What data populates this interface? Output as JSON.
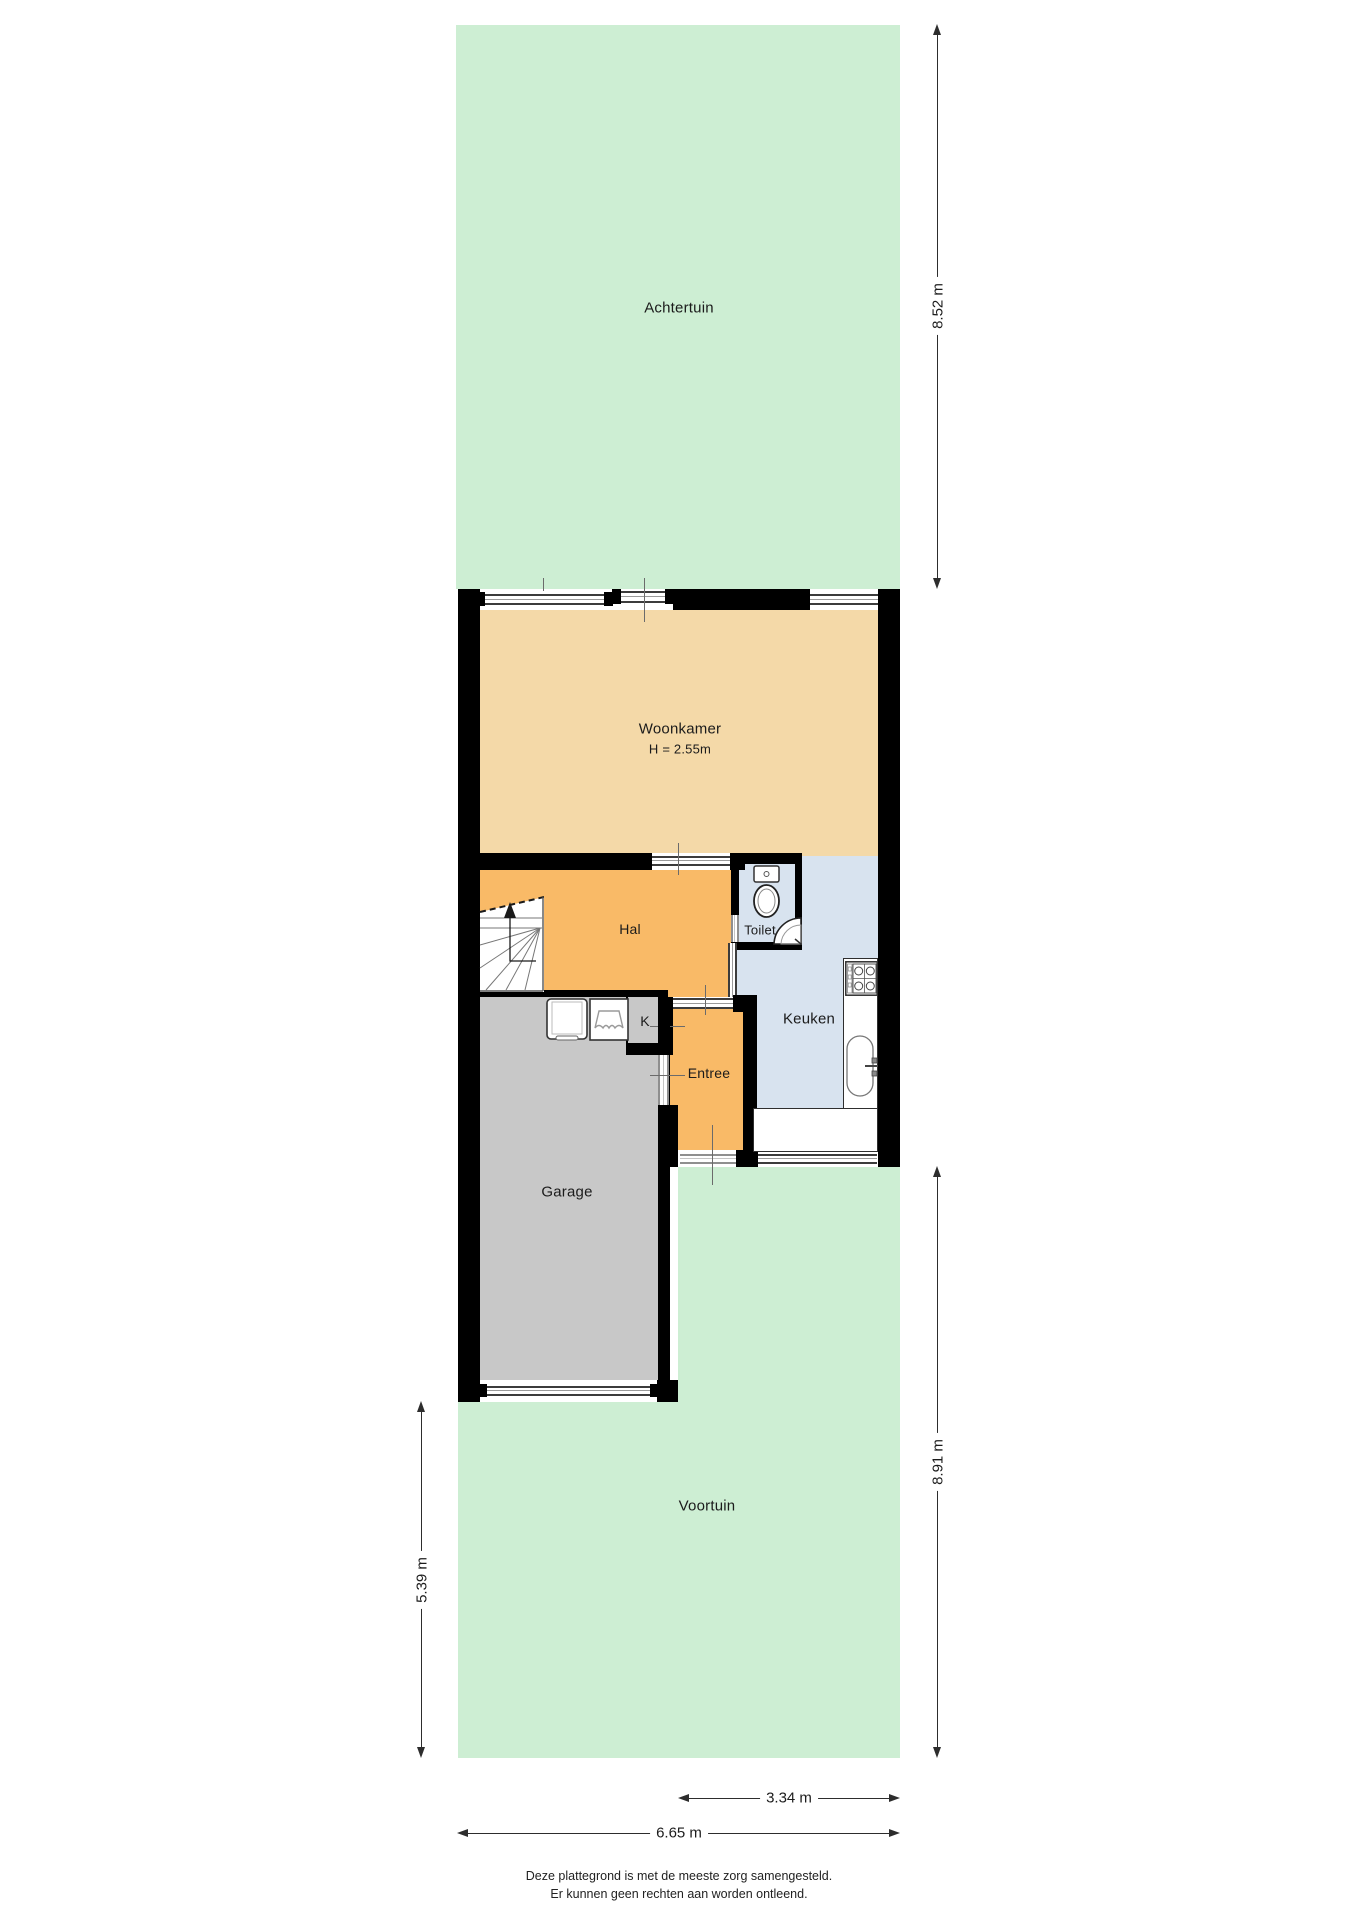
{
  "rooms": {
    "achtertuin": "Achtertuin",
    "woonkamer": "Woonkamer",
    "woonkamer_height": "H = 2.55m",
    "hal": "Hal",
    "toilet": "Toilet",
    "keuken": "Keuken",
    "kast": "K",
    "entree": "Entree",
    "garage": "Garage",
    "voortuin": "Voortuin"
  },
  "dimensions": {
    "achtertuin_depth": "8.52 m",
    "voortuin_depth_right": "8.91 m",
    "voortuin_depth_left": "5.39 m",
    "front_width_partial": "3.34 m",
    "front_width_total": "6.65 m"
  },
  "footer": {
    "line1": "Deze plattegrond is met de meeste zorg samengesteld.",
    "line2": "Er kunnen geen rechten aan worden ontleend."
  },
  "colors": {
    "garden": "#cdeed3",
    "living_room": "#f4d9a8",
    "hall": "#f9ba67",
    "closet": "#dab076",
    "kitchen": "#d8e3ef",
    "garage": "#c8c8c8",
    "wall": "#000000",
    "dimension": "#2d2d2d"
  },
  "icons": {
    "stairs": "stairs-icon",
    "cistern": "cistern-icon",
    "toilet_bowl": "toilet-bowl-icon",
    "corner_basin": "corner-basin-icon",
    "stove": "stove-icon",
    "sink": "sink-icon",
    "washing_machine": "washing-machine-icon",
    "laundry_basket": "laundry-basket-icon"
  }
}
